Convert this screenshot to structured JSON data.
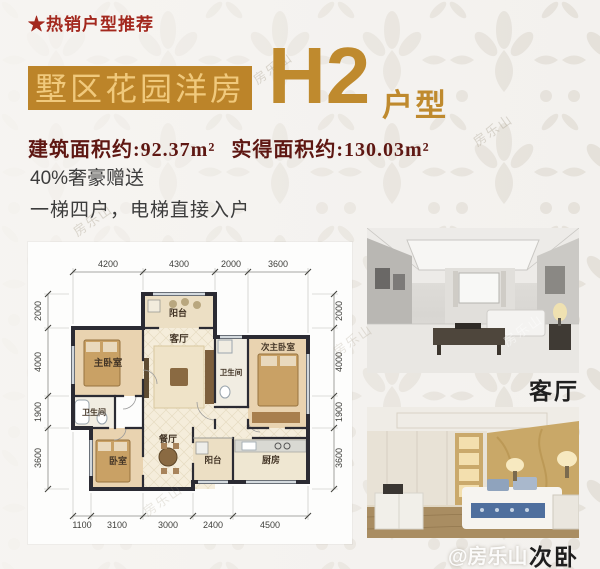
{
  "header": {
    "tag": "★热销户型推荐",
    "title": "墅区花园洋房",
    "unit_code": "H2",
    "unit_suffix": "户型"
  },
  "specs": {
    "area_built": "建筑面积约:92.37m²",
    "area_actual": "实得面积约:130.03m²",
    "feature_gift": "40%奢豪赠送",
    "feature_elevator": "一梯四户，电梯直接入户"
  },
  "floorplan": {
    "dims_top": [
      "4200",
      "4300",
      "2000",
      "3600"
    ],
    "dims_bottom": [
      "1100",
      "3100",
      "3000",
      "2400",
      "4500"
    ],
    "dims_left": [
      "2000",
      "4000",
      "1900",
      "3600"
    ],
    "dims_right": [
      "2000",
      "4000",
      "1900",
      "3600"
    ],
    "rooms": {
      "balcony_top": "阳台",
      "master_bedroom": "主卧室",
      "living_room": "客厅",
      "bathroom_mid": "卫生间",
      "second_master_bedroom": "次主卧室",
      "bathroom_left": "卫生间",
      "bedroom": "卧室",
      "dining_room": "餐厅",
      "balcony_bottom": "阳台",
      "kitchen": "厨房"
    }
  },
  "photos": {
    "living": {
      "label": "客厅"
    },
    "bedroom": {
      "label": "次卧"
    }
  },
  "watermark": {
    "badge": "@房乐山",
    "diagonal": "房乐山"
  },
  "colors": {
    "accent_orange": "#bc8429",
    "accent_gold": "#f0c97c",
    "accent_red": "#a3281e",
    "area_text": "#5e1712"
  }
}
